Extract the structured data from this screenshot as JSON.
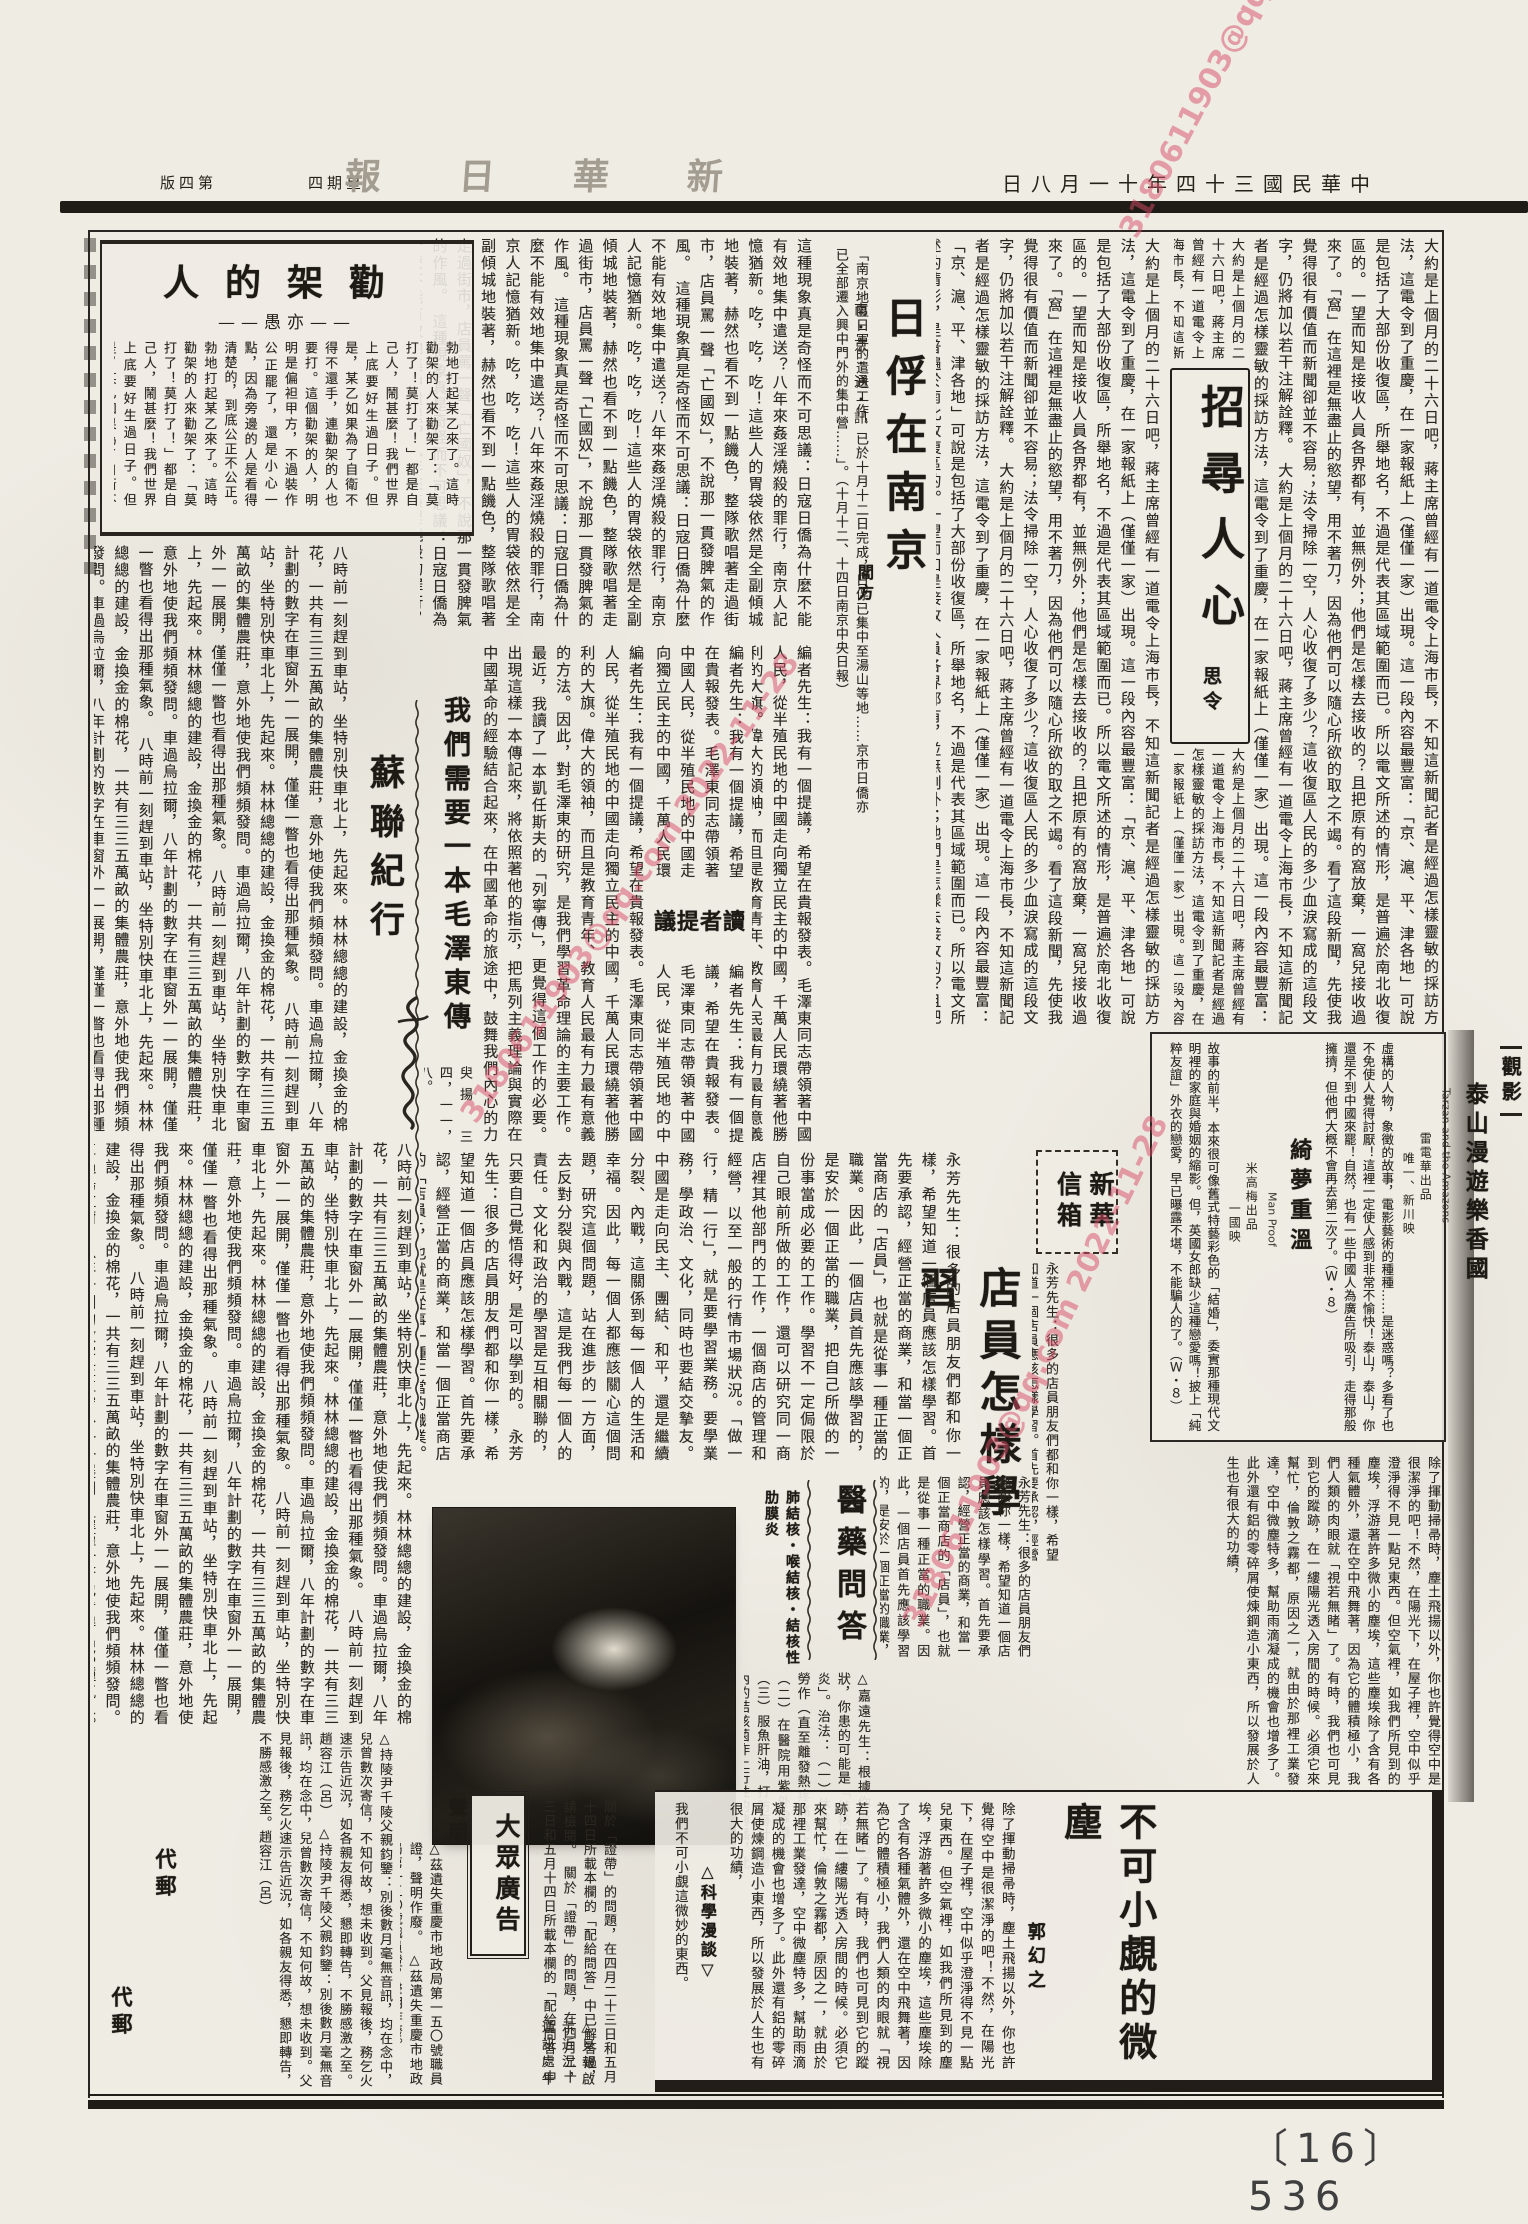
{
  "colors": {
    "paper": "#efece4",
    "ink": "#272219",
    "watermark": "#d84b66"
  },
  "watermark": {
    "text": "3180611903@qq.com 2022-11-28"
  },
  "header": {
    "page_label": "第四版",
    "weekday": "星期四",
    "masthead": "新華日報",
    "date": "中華民國三十四年十一月八日"
  },
  "footer": {
    "page_number": "〔16〕 536"
  },
  "zhaoxun": {
    "title": "招尋人心",
    "byline": "思令",
    "excerpt": "大約是上個月的二十六日吧，蔣主席曾經有一道電令上海市長，不知這新聞記者是經過怎樣靈敏的採訪方法，這電令到了重慶，在一家報紙上（僅僅一家）出現。這一段內容最豐富：「京、滬、平、津各地」可說是包括了大部份收復區，所舉地名，不過是代表其區域範圍而已。所以電文所述的情形，是普遍於南北收復區的。一望而知是接收人員各界都有，並無例外；他們是怎樣去接收的？且把原有的窩放棄，一窩兒接收過來了。「窩」在這裡是無盡止的慾望，用不著刀，因為他們可以隨心所欲的取之不竭。看了這段新聞，先使我覺得很有價值而新聞卻並不容易；法令掃除一空，人心收復了多少？這收復區人民的多少血淚寫成的這段文字，仍將加以若干注解詮釋。"
  },
  "rifu": {
    "title": "日俘在南京",
    "subtitle": "南・京・通・訊",
    "byline": "閻方",
    "intro": "「南京地區日軍的遣送工作，已於十月十二日完成，日俘已集中至湯山等地……京市日僑亦已全部遷入興中門外的集中營……」。（十月十二、十四日南京中央日報）",
    "excerpt": "這種現象真是奇怪而不可思議：日寇日僑為什麼不能有效地集中遣送？八年來姦淫燒殺的罪行，南京人記憶猶新。吃，吃，吃！這些人的胃袋依然是全副傾城地裝著，赫然也看不到一點饑色，整隊歌唱著走過街市，店員罵一聲「亡國奴」，不說那一貫發脾氣的作風。"
  },
  "quanjia": {
    "title": "勸架的人",
    "byline": "——亦愚——",
    "excerpt": "勃地打起某乙來了。這時勸架的人來勸架了：「莫打了！莫打了！」都是自己人，鬧甚麼！我們世界上底要好生過日子。但是，某乙如果為了自衛不得不還手，連勸架的人也要打。這個勸架的人，明明是偏袒甲方，不過裝作公正罷了，還是小心一點，因為旁邊的人是看得清楚的，到底公正不公正。"
  },
  "sulian": {
    "title": "蘇聯紀行",
    "excerpt": "八時前一刻趕到車站，坐特別快車北上，先起來。林林總總的建設，金換金的棉花，一共有三三五萬畝的集體農莊，意外地使我們頻頻發問。車過烏拉爾，八年計劃的數字在車窗外一一展開，僅僅一瞥也看得出那種氣象。"
  },
  "duzhe": {
    "label": "讀者提議",
    "title": "我們需要一本毛澤東傳",
    "excerpt": "編者先生：我有一個提議，希望在貴報發表。毛澤東同志帶領著中國人民，從半殖民地的中國走向獨立民主的中國，千萬人民環繞著他勝利的大旗。偉大的領袖，而且是教育青年、教育人民最有力最有意義的方法。因此，對毛澤東的研究，是我們學習革命理論的主要工作。最近，我讀了一本凱任斯夫的「列寧傳」，更覺得這個工作的必要。出現這樣一本傳記來，將依照著他的指示，把馬列主義理論與實際在中國革命的經驗結合起來，在中國革命的旅途中，鼓舞我們內心的力量。毛澤東就是新中國的呼聲；我們需要一本毛澤東傳！",
    "signature": "臾揚",
    "date": "三四，一一，八。"
  },
  "xinhua": {
    "label": "新華信箱",
    "title": "店員怎樣學習",
    "excerpt": "永芳先生：很多的店員朋友們都和你一樣，希望知道一個店員應該怎樣學習。首先要承認，經營正當的商業，和當一個正當商店的「店員」，也就是從事一種正當的職業。因此，一個店員首先應該學習的，是安於一個正當的職業，把自己所做的一份事當成必要的工作。學習不一定侷限於自己眼前所做的工作，還可以研究同一商店裡其他部門的工作，一個商店的管理和經營，以至一般的行情市場狀況。「做一行，精一行」，就是要學習業務。要學業務，學政治、文化，同時也要結交摯友。中國是走向民主、團結、和平，還是繼續分裂、內戰，這關係到每一個人的生活和幸福。因此，每一個人都應該關心這個問題，研究這個問題，站在進步的一方面，去反對分裂與內戰，這是我們每一個人的責任。文化和政治的學習是互相關聯的，只要自己覺悟得好，是可以學到的。"
  },
  "guanying": {
    "label": "觀影",
    "films": [
      {
        "title": "泰山漫遊樂香國",
        "title_en": "Tarzan and the Amazons",
        "studio": "雷電華出品",
        "cinema": "唯一、新川映",
        "review": "虛構的人物，象徵的故事，電影藝術的種種……是迷惑嗎？多看了也不免使人覺得討厭！這裡一定使人感到非常不愉快！泰山，泰山，你還是不到中國來罷！自然，也有一些中國人為廣告所吸引，走得那般擁擠，但他們大概不會再去第二次了。（Ｗ・８）"
      },
      {
        "title": "綺夢重溫",
        "title_en": "Man Proof",
        "studio": "米高梅出品",
        "cinema": "一國映",
        "review": "故事的前半，本來很可像舊式特藝彩色的「結婚」，委實那種現代文明裡的家庭與婚姻的縮影。但，英國女郎缺少這種戀愛嗎！披上「純粹友誼」外衣的戀愛，早已曝露不堪，不能騙人的了。（Ｗ・８）"
      }
    ]
  },
  "yiyao": {
    "title": "醫藥問答",
    "subtitle": "肺結核・喉結核・結核性肋膜炎",
    "excerpt": "△嘉遠先生：根據你所說的症狀，你患的可能是「結核性肋膜炎」。治法：（一）休養，不做勞作（直至離發熱疼痛為止）。（二）在醫院用紫外線療法。（三）服魚肝油，打防癆針。體內的結核菌作上行性的傳播，此菌多不能使聲帶全形變化，他部結核既不能剷除，又無特效藥，故祇能作對症療法而已。"
  },
  "weichen": {
    "title": "不可小覷的微塵",
    "byline": "郭幻之",
    "label": "△科學漫談▽",
    "excerpt": "除了揮動掃帚時，塵土飛揚以外，你也許覺得空中是很潔淨的吧！不然，在陽光下，在屋子裡，空中似乎澄淨得不見一點兒東西。但空氣裡，如我們所見到的塵埃，浮游著許多微小的塵埃，這些塵埃除了含有各種氣體外，還在空中飛舞著，因為它的體積極小，我們人類的肉眼就「視若無睹」了。有時，我們也可見到它的蹤跡，在一縷陽光透入房間的時候。必須它來幫忙，倫敦之霧都，原因之一，就由於那裡工業發達，空中微塵特多，幫助雨滴凝成的機會也增多了。此外還有鋁的零碎屑使煉鋼造小東西，所以發展於人生也有很大的功績，",
    "ending": "我們不可小覷這微妙的東西。"
  },
  "dazhong": {
    "title": "大眾廣告",
    "shengming_label": "聲明",
    "daiyou_label": "代郵",
    "notice_a": "關於「證帶」的問題，在四月二十三日和五月十四日所載本欄的「配給問答」中已解答過，請檢閱。",
    "notice_b": "△茲遺失重慶市地政局第一五〇號職員證，聲明作廢。",
    "notice_c": "△持陵尹千陵父親鈞鑒：別後數月毫無音訊，均在念中，兒曾數次寄信，不知何故，想未收到。父見報後，務乞火速示告近況，如各親友得悉，懇即轉告，不勝感激之至。趙容江（呂）",
    "notice_d": "△見報啟示近況，通訊處牛角沱三〇號。"
  }
}
